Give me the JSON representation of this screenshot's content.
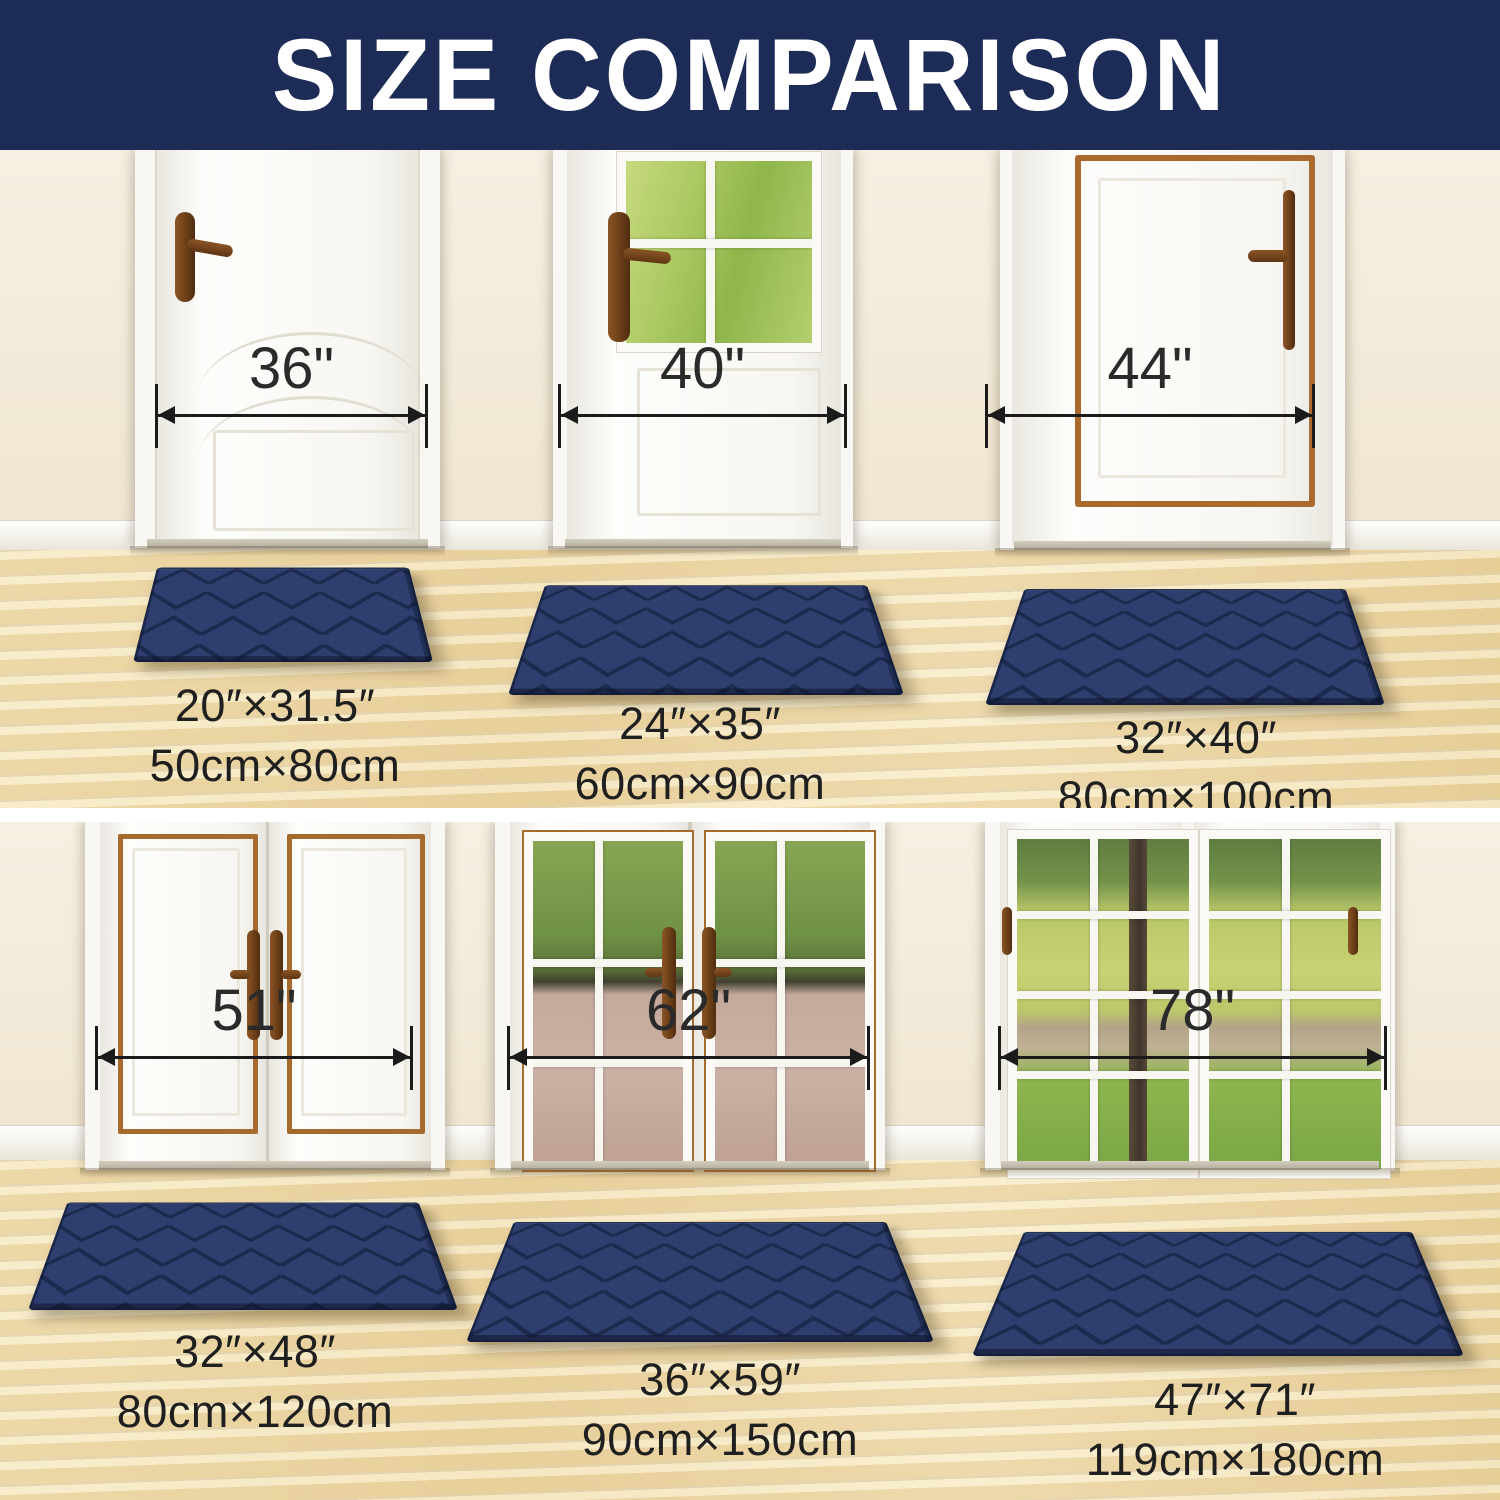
{
  "banner": {
    "title": "SIZE COMPARISON",
    "bg_color": "#1d2b57",
    "text_color": "#ffffff"
  },
  "mat_style": {
    "mat_color": "#2e3e6e",
    "pattern_line_color": "#1c2a4e",
    "pattern": "chevron-basketweave"
  },
  "sections": {
    "top": {
      "doors": [
        {
          "width": "36\""
        },
        {
          "width": "40\""
        },
        {
          "width": "44\""
        }
      ],
      "mats": [
        {
          "inches": "20″×31.5″",
          "cm": "50cm×80cm"
        },
        {
          "inches": "24″×35″",
          "cm": "60cm×90cm"
        },
        {
          "inches": "32″×40″",
          "cm": "80cm×100cm"
        }
      ]
    },
    "bottom": {
      "doors": [
        {
          "width": "51\""
        },
        {
          "width": "62\""
        },
        {
          "width": "78\""
        }
      ],
      "mats": [
        {
          "inches": "32″×48″",
          "cm": "80cm×120cm"
        },
        {
          "inches": "36″×59″",
          "cm": "90cm×150cm"
        },
        {
          "inches": "47″×71″",
          "cm": "119cm×180cm"
        }
      ]
    }
  }
}
